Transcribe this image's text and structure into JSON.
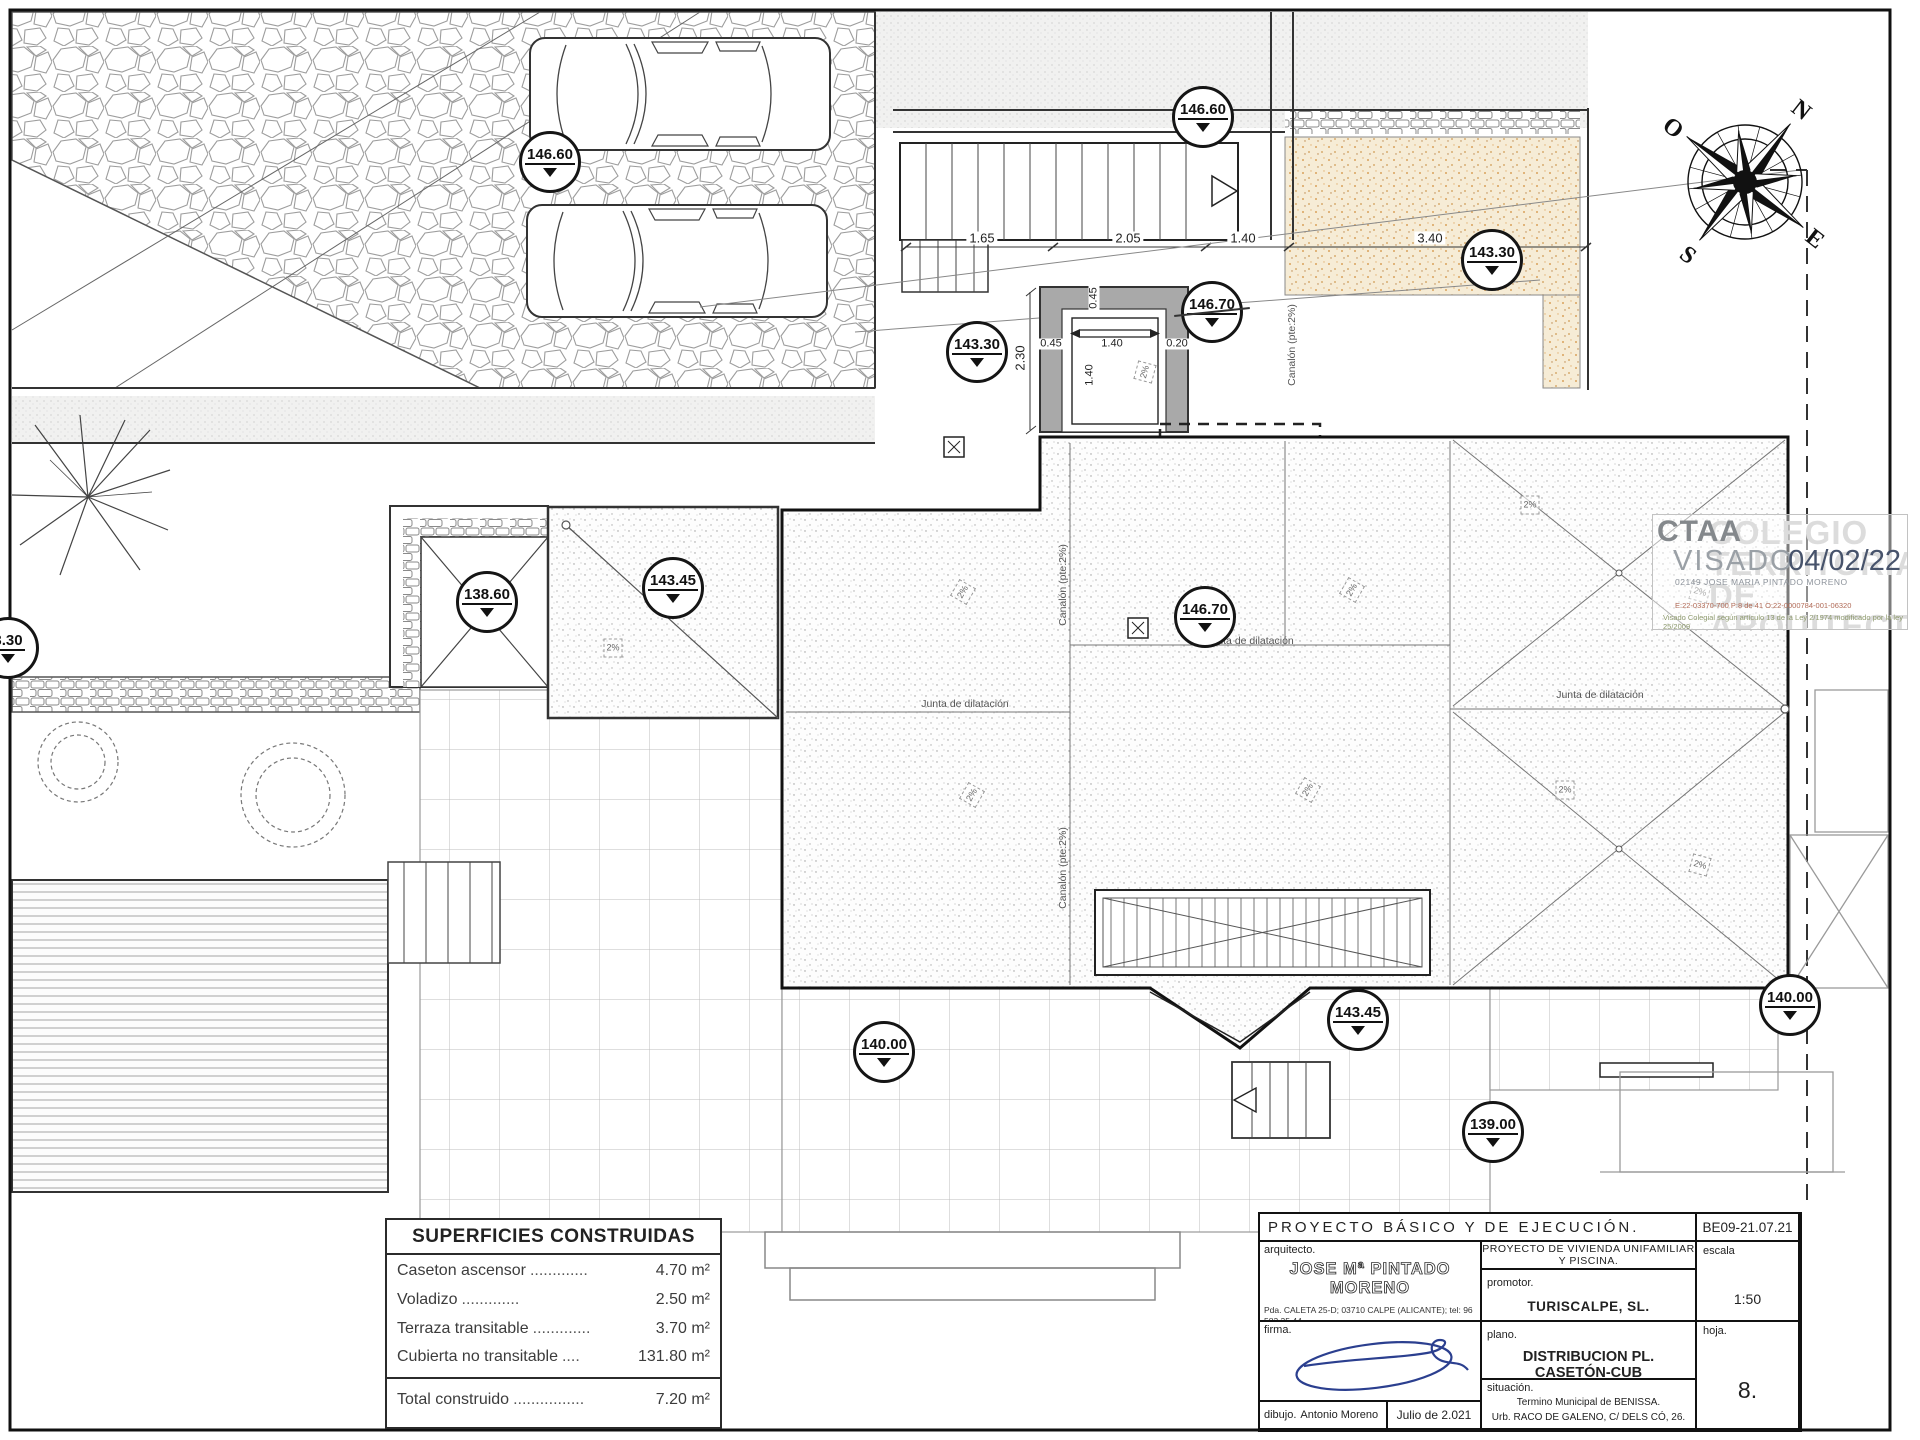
{
  "markers": [
    {
      "value": "146.60"
    },
    {
      "value": "146.60"
    },
    {
      "value": "143.30"
    },
    {
      "value": "146.70",
      "crossed": true
    },
    {
      "value": "143.30"
    },
    {
      "value": "138.60"
    },
    {
      "value": "143.45"
    },
    {
      "value": "146.70"
    },
    {
      "value": "3.30"
    },
    {
      "value": "140.00"
    },
    {
      "value": "143.45"
    },
    {
      "value": "140.00"
    },
    {
      "value": "139.00"
    }
  ],
  "dims": {
    "d165": "1.65",
    "d205": "2.05",
    "d140": "1.40",
    "d340": "3.40",
    "d230": "2.30",
    "d045": "0.45",
    "d140b": "1.40",
    "d020": "0.20",
    "d140c": "1.40",
    "d045b": "0.45"
  },
  "labels": {
    "junta": "Junta de dilatación",
    "canalon": "Canalón (pte:2%)",
    "slope": "2%"
  },
  "compass": {
    "n": "N",
    "e": "E",
    "s": "S",
    "o": "O"
  },
  "visado": {
    "org_acronym": "CTAA",
    "org_bg1": "COLEGIO",
    "org_bg2": "TERRITORIAL",
    "org_bg3": "DE ARQUITECTOS",
    "stamp_word": "VISADO",
    "date": "04/02/22",
    "holder": "02149  JOSE MARIA PINTADO MORENO",
    "refs": "E:22-03370-700      P:8 de 41      O:22-0000784-001-06320",
    "legal": "Visado Colegial según artículo 13 de la Ley 2/1974 modificado por la ley 25/2009"
  },
  "superficies": {
    "title": "SUPERFICIES CONSTRUIDAS",
    "rows": [
      {
        "label": "Caseton ascensor",
        "dots": ".............",
        "value": "4.70 m²"
      },
      {
        "label": "Voladizo",
        "dots": ".............",
        "value": "2.50 m²"
      },
      {
        "label": "Terraza transitable",
        "dots": ".............",
        "value": "3.70 m²"
      },
      {
        "label": "Cubierta no transitable",
        "dots": "....",
        "value": "131.80 m²"
      }
    ],
    "total": {
      "label": "Total construido",
      "dots": "................",
      "value": "7.20 m²"
    }
  },
  "title_block": {
    "project_header": "PROYECTO  BÁSICO  Y  DE  EJECUCIÓN.",
    "code": "BE09-21.07.21",
    "architect_label": "arquitecto.",
    "architect_name": "JOSE Mª PINTADO MORENO",
    "architect_address": "Pda. CALETA 25-D; 03710 CALPE (ALICANTE); tel: 96 583 35 44.",
    "architect_email": "e.mail: pintadoyrico@telefonica.net",
    "firma_label": "firma.",
    "dibujo_label": "dibujo.",
    "dibujo_name": "Antonio Moreno",
    "date": "Julio de 2.021",
    "project_title": "PROYECTO  DE  VIVIENDA  UNIFAMILIAR  Y  PISCINA.",
    "promotor_label": "promotor.",
    "promotor_name": "TURISCALPE, SL.",
    "plano_label": "plano.",
    "plano_name": "DISTRIBUCION  PL.  CASETÓN-CUB",
    "situacion_label": "situación.",
    "situacion_line1": "Termino Municipal de BENISSA.",
    "situacion_line2": "Urb. RACO DE GALENO, C/ DELS CÓ, 26.",
    "escala_label": "escala",
    "escala_value": "1:50",
    "hoja_label": "hoja.",
    "hoja_value": "8."
  }
}
